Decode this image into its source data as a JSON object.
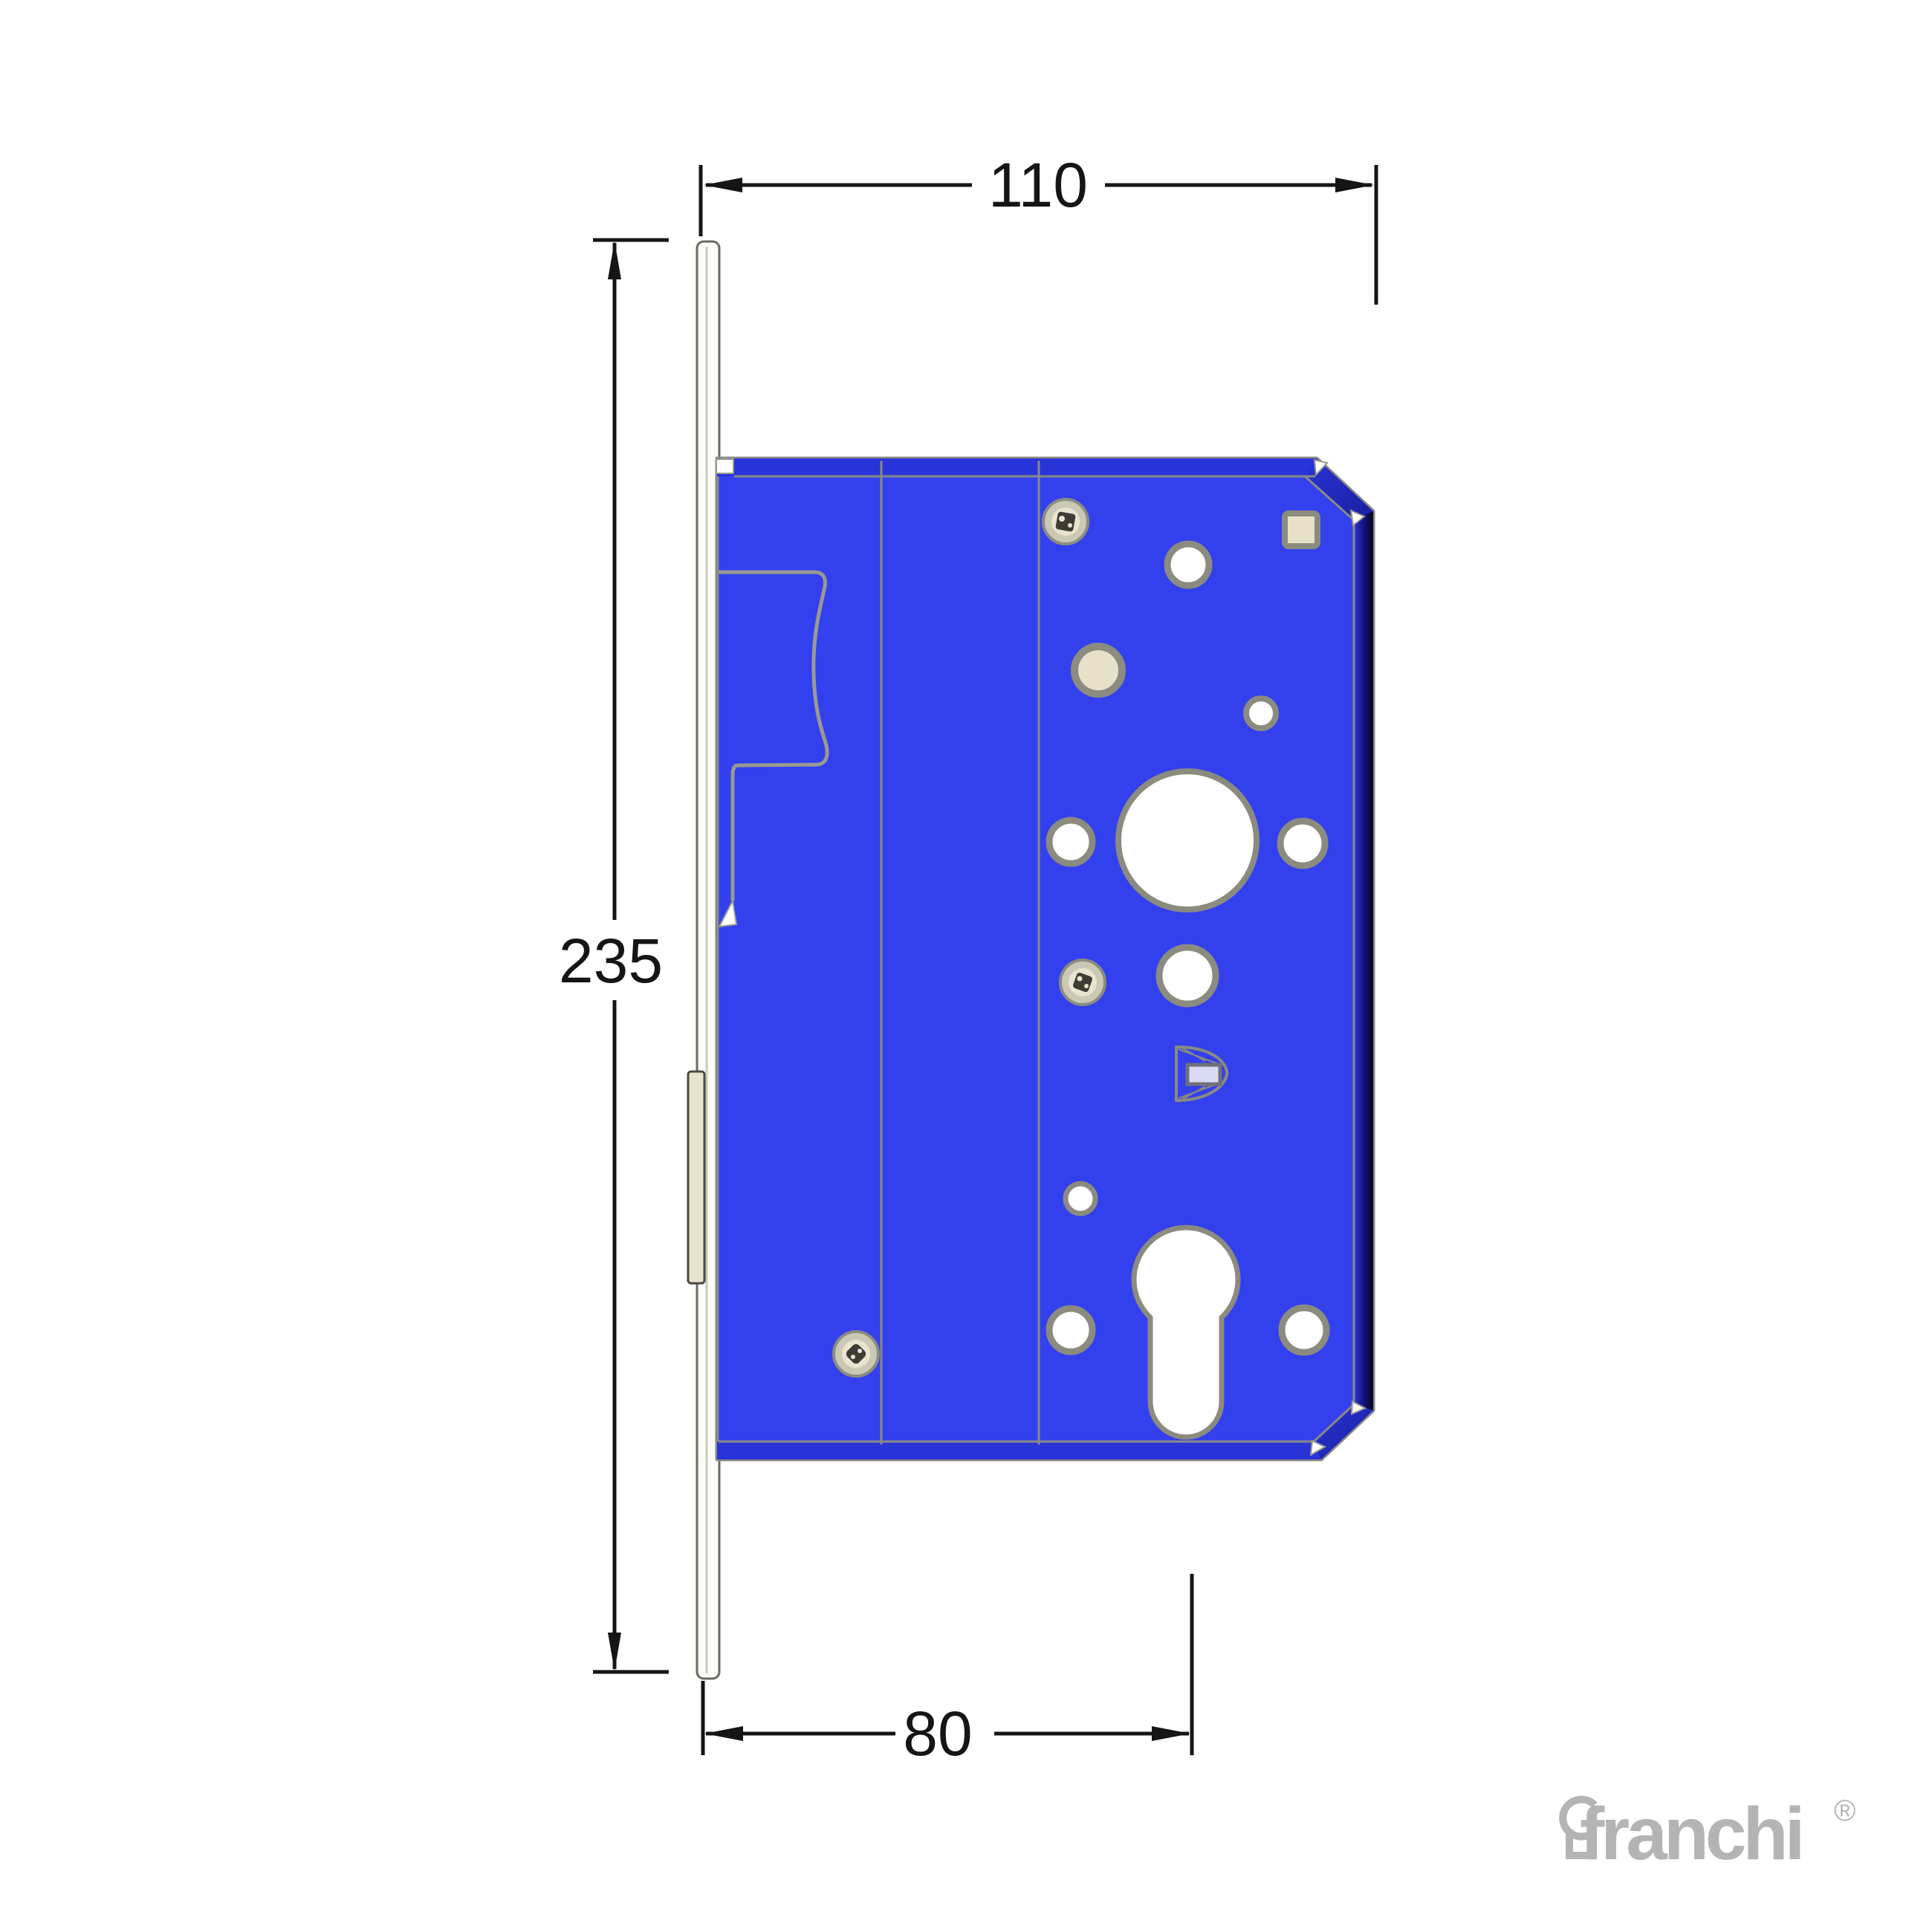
{
  "diagram": {
    "title": "mortice-lock-case-technical-drawing",
    "dimensions": {
      "overall_width": "110",
      "faceplate_height": "235",
      "backset": "80"
    },
    "parts": {
      "faceplate": "faceplate-strip",
      "deadbolt": "deadbolt",
      "lock_case": "lock-case-blue-plate",
      "latch_outline": "latchbolt-housing-outline",
      "euro_cylinder": "euro-profile-cylinder-hole",
      "spindle_hole": "main-spindle-hole",
      "square_hole": "square-hole",
      "spring_clip": "spring-clip-detail",
      "screws": [
        "screw-top",
        "screw-middle",
        "screw-bottom-left"
      ]
    }
  },
  "logo": {
    "brand": "franchi",
    "registered": "®",
    "icon": "keyhole-icon"
  },
  "colors": {
    "case_blue": "#3340ee",
    "band_blue": "#2833d8",
    "edge_navy": "#06061f",
    "outline_gray": "#8a8a85",
    "panel_line_gray": "#9a9a92",
    "hole_ring_gray": "#8b8b80",
    "beige": "#e8e1ca",
    "faceplate_white": "#fcfcf9",
    "bolt_beige": "#e9e2cd",
    "dim_black": "#151515",
    "logo_gray": "#b4b4b4",
    "bracket_lavender": "#d9dbf4"
  }
}
